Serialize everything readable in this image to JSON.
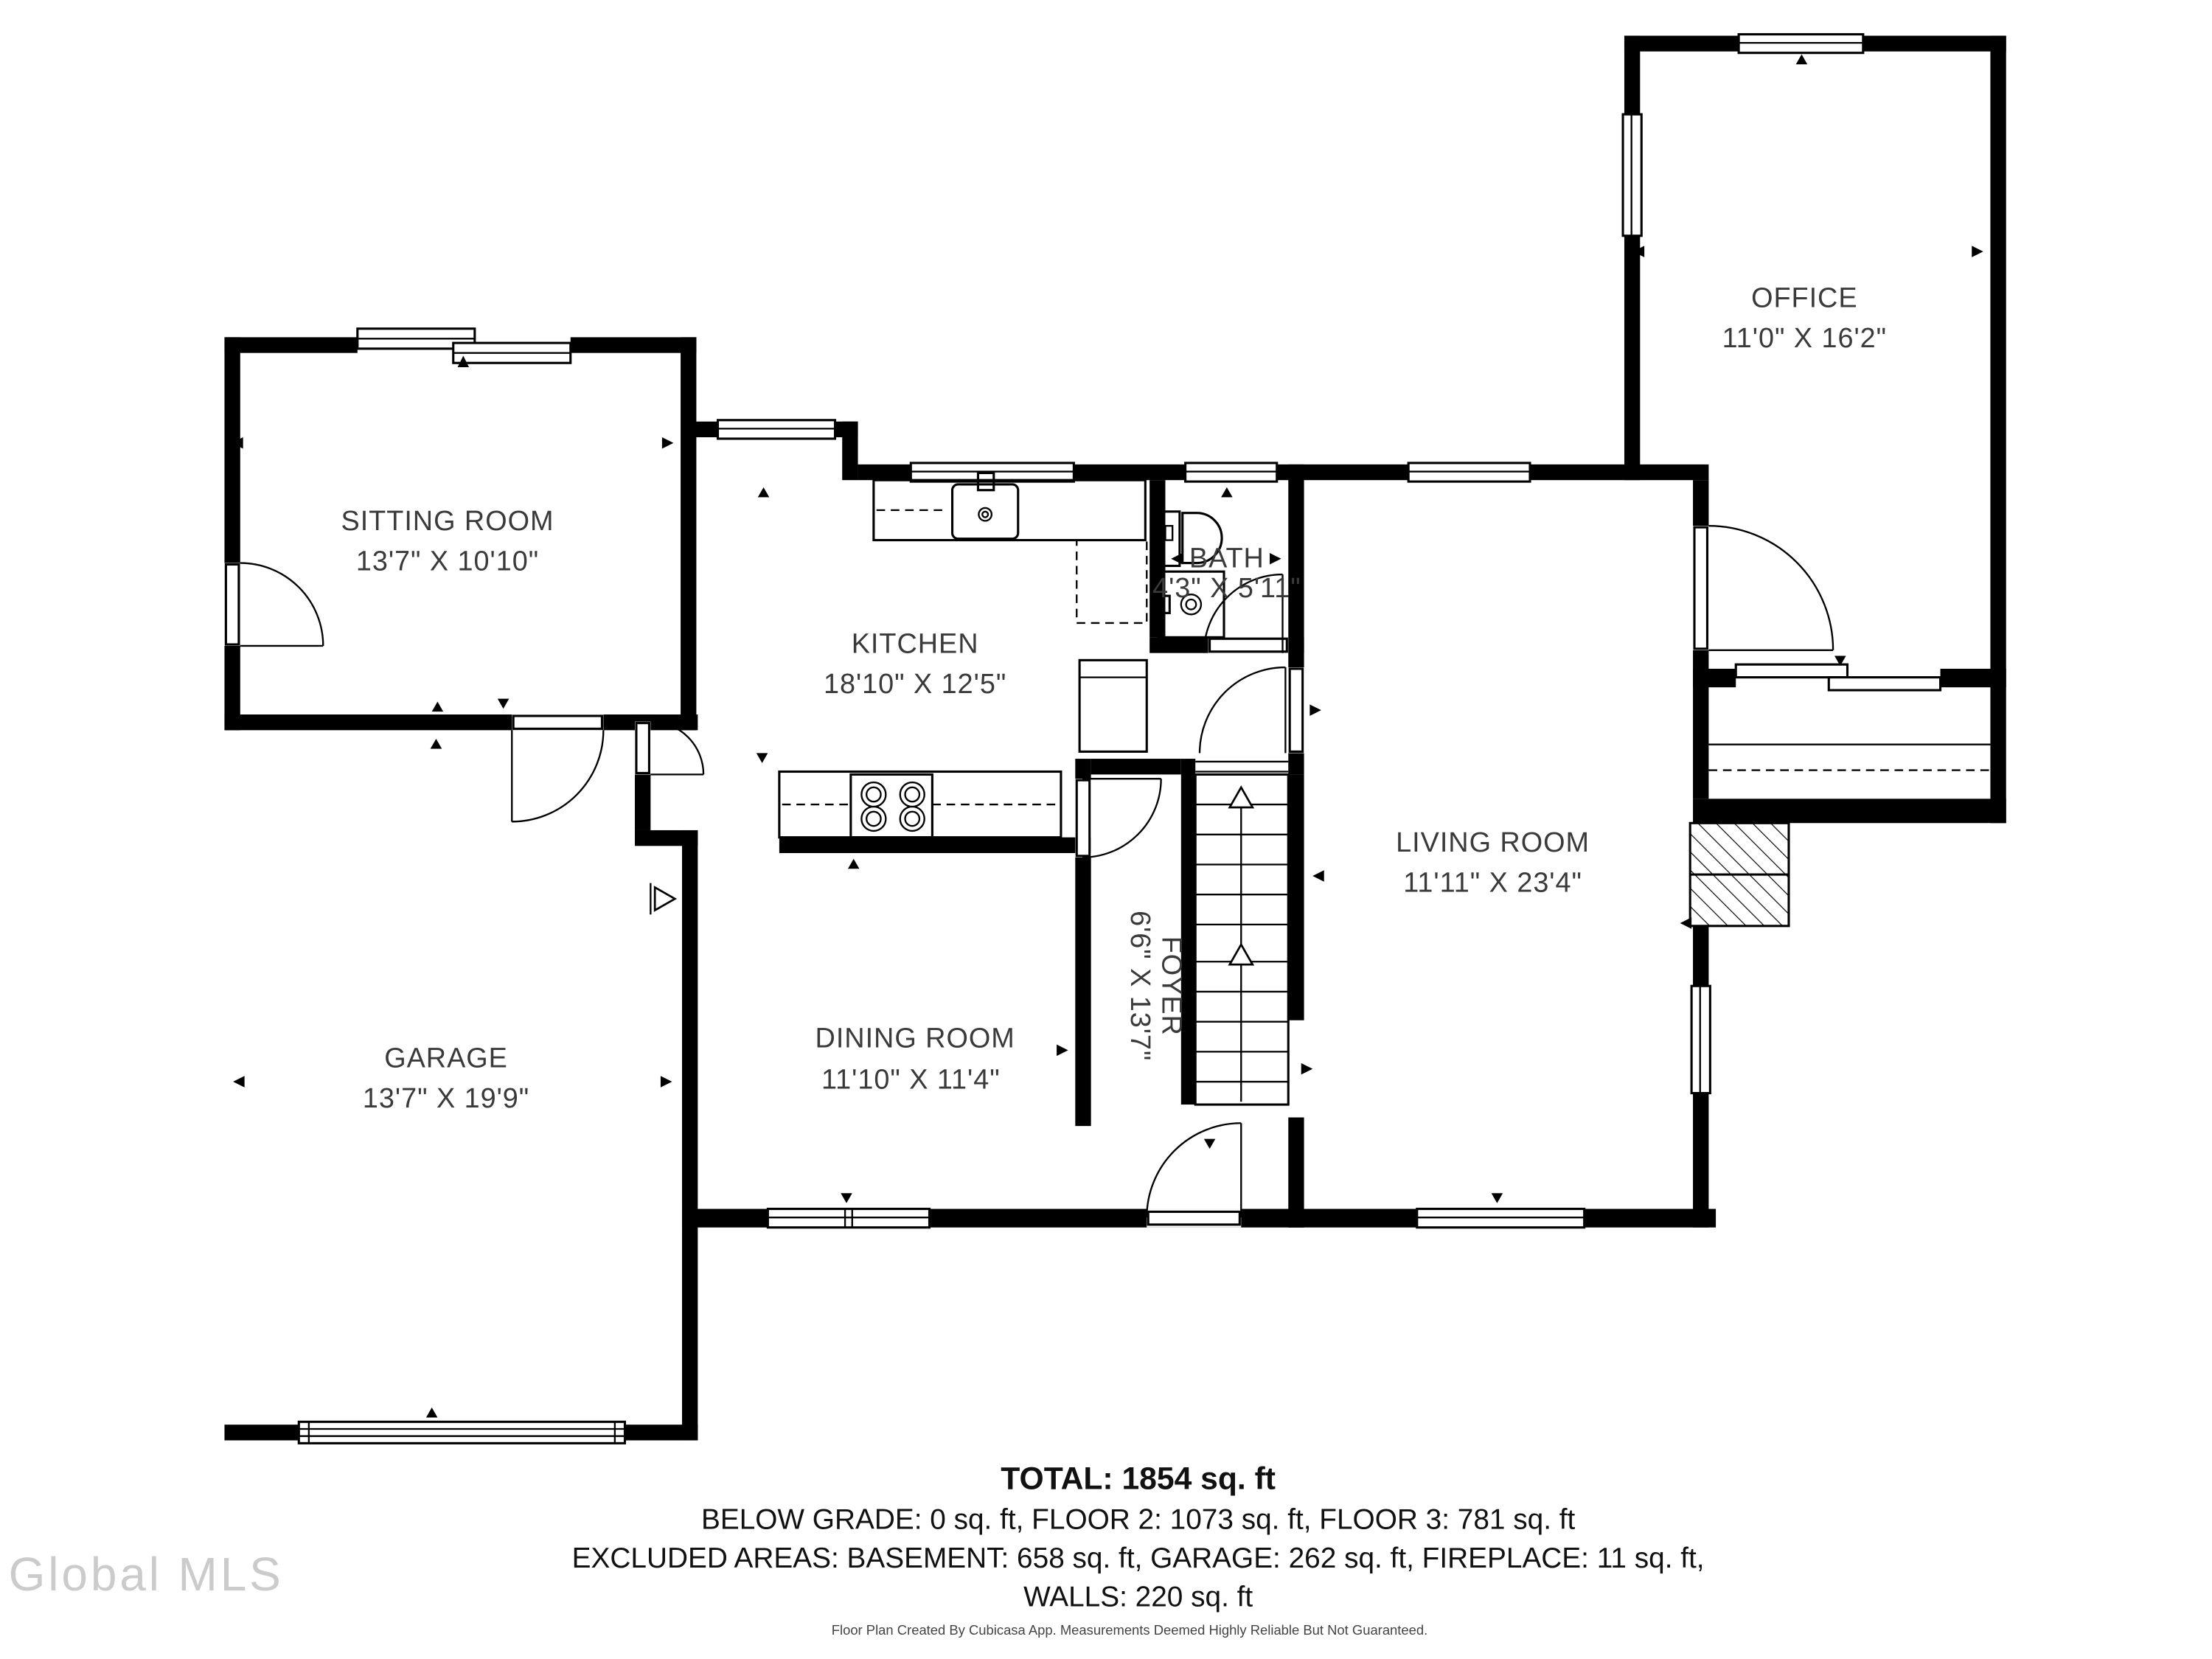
{
  "plan": {
    "rooms": {
      "sitting": {
        "name": "SITTING ROOM",
        "dims": "13'7\" X 10'10\""
      },
      "kitchen": {
        "name": "KITCHEN",
        "dims": "18'10\" X 12'5\""
      },
      "bath": {
        "name": "BATH",
        "dims": "4'3\" X 5'11\""
      },
      "office": {
        "name": "OFFICE",
        "dims": "11'0\" X 16'2\""
      },
      "garage": {
        "name": "GARAGE",
        "dims": "13'7\" X 19'9\""
      },
      "dining": {
        "name": "DINING ROOM",
        "dims": "11'10\" X 11'4\""
      },
      "living": {
        "name": "LIVING ROOM",
        "dims": "11'11\" X 23'4\""
      },
      "foyer": {
        "name": "FOYER",
        "dims": "6'6\" X 13'7\""
      }
    },
    "summary": {
      "total": "TOTAL: 1854 sq. ft",
      "line2": "BELOW GRADE: 0 sq. ft, FLOOR 2: 1073 sq. ft, FLOOR 3: 781 sq. ft",
      "line3": "EXCLUDED AREAS: BASEMENT: 658 sq. ft, GARAGE: 262 sq. ft, FIREPLACE: 11 sq. ft,",
      "line4": "WALLS: 220 sq. ft"
    },
    "footer": "Floor Plan Created By Cubicasa App. Measurements Deemed Highly Reliable But Not Guaranteed.",
    "watermark": "Global MLS",
    "colors": {
      "wall": "#000000",
      "label": "#3a3a3a",
      "watermark": "#cbcbcb"
    }
  }
}
